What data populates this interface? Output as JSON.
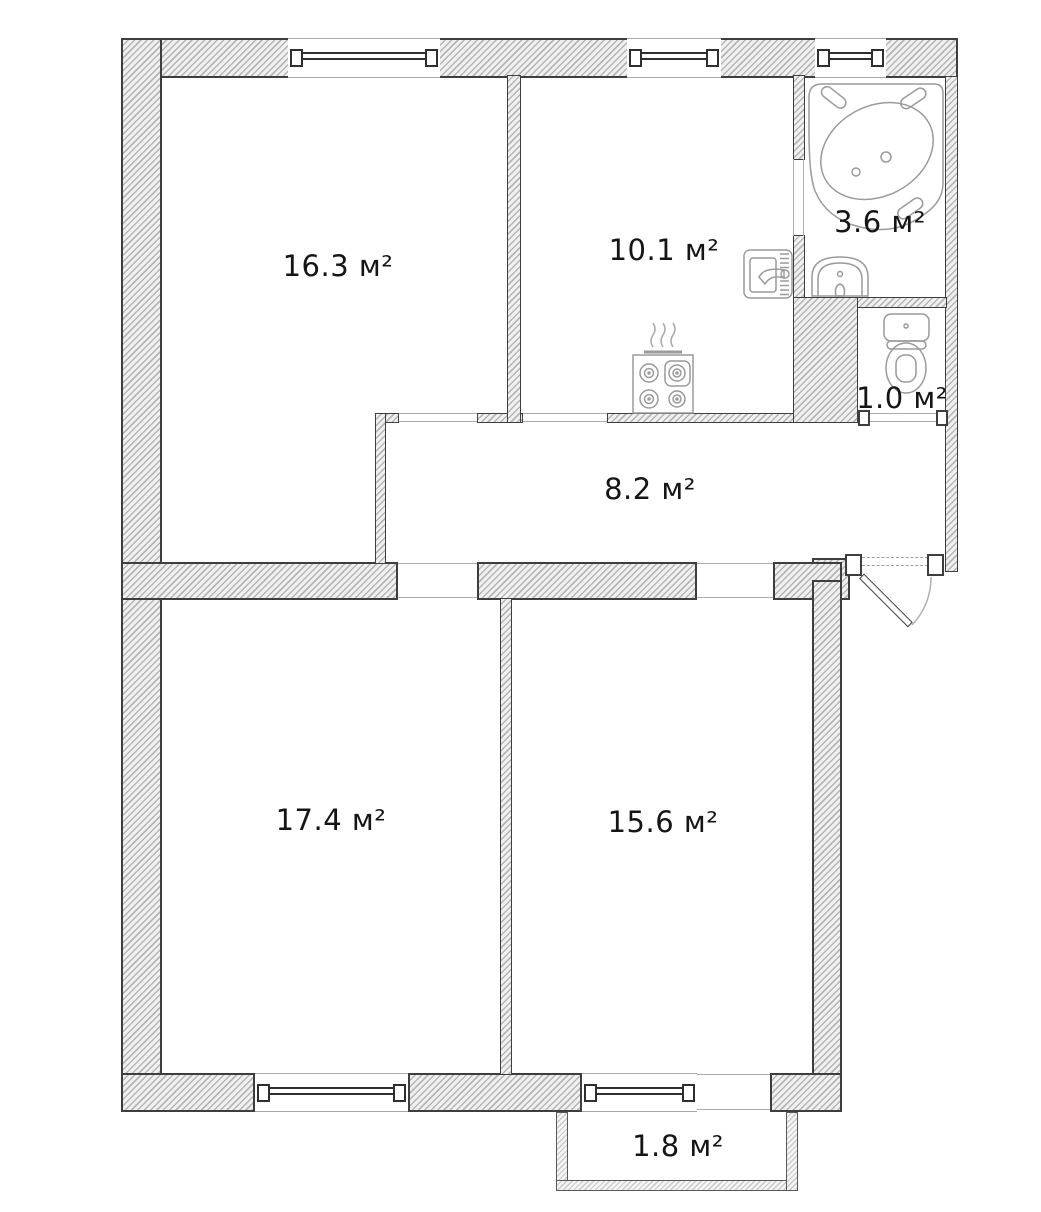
{
  "plan": {
    "title": "apartment-floor-plan",
    "units": "м²",
    "rooms": [
      {
        "id": "living-room",
        "area_label": "16.3 м²"
      },
      {
        "id": "kitchen",
        "area_label": "10.1 м²"
      },
      {
        "id": "bathroom",
        "area_label": "3.6 м²"
      },
      {
        "id": "toilet",
        "area_label": "1.0 м²"
      },
      {
        "id": "hallway",
        "area_label": "8.2 м²"
      },
      {
        "id": "bedroom-left",
        "area_label": "17.4 м²"
      },
      {
        "id": "bedroom-right",
        "area_label": "15.6 м²"
      },
      {
        "id": "balcony",
        "area_label": "1.8 м²"
      }
    ],
    "fixtures": [
      "bathtub-icon",
      "washbasin-icon",
      "toilet-icon",
      "kitchen-sink-icon",
      "stove-icon",
      "entrance-door"
    ],
    "colors": {
      "background": "#ffffff",
      "wall_outline": "#3e3e3e",
      "wall_hatch": "#b6b6b6",
      "wall_fill": "#f0f0f0",
      "fixture_line": "#9a9a9a",
      "label_text": "#151515"
    }
  }
}
